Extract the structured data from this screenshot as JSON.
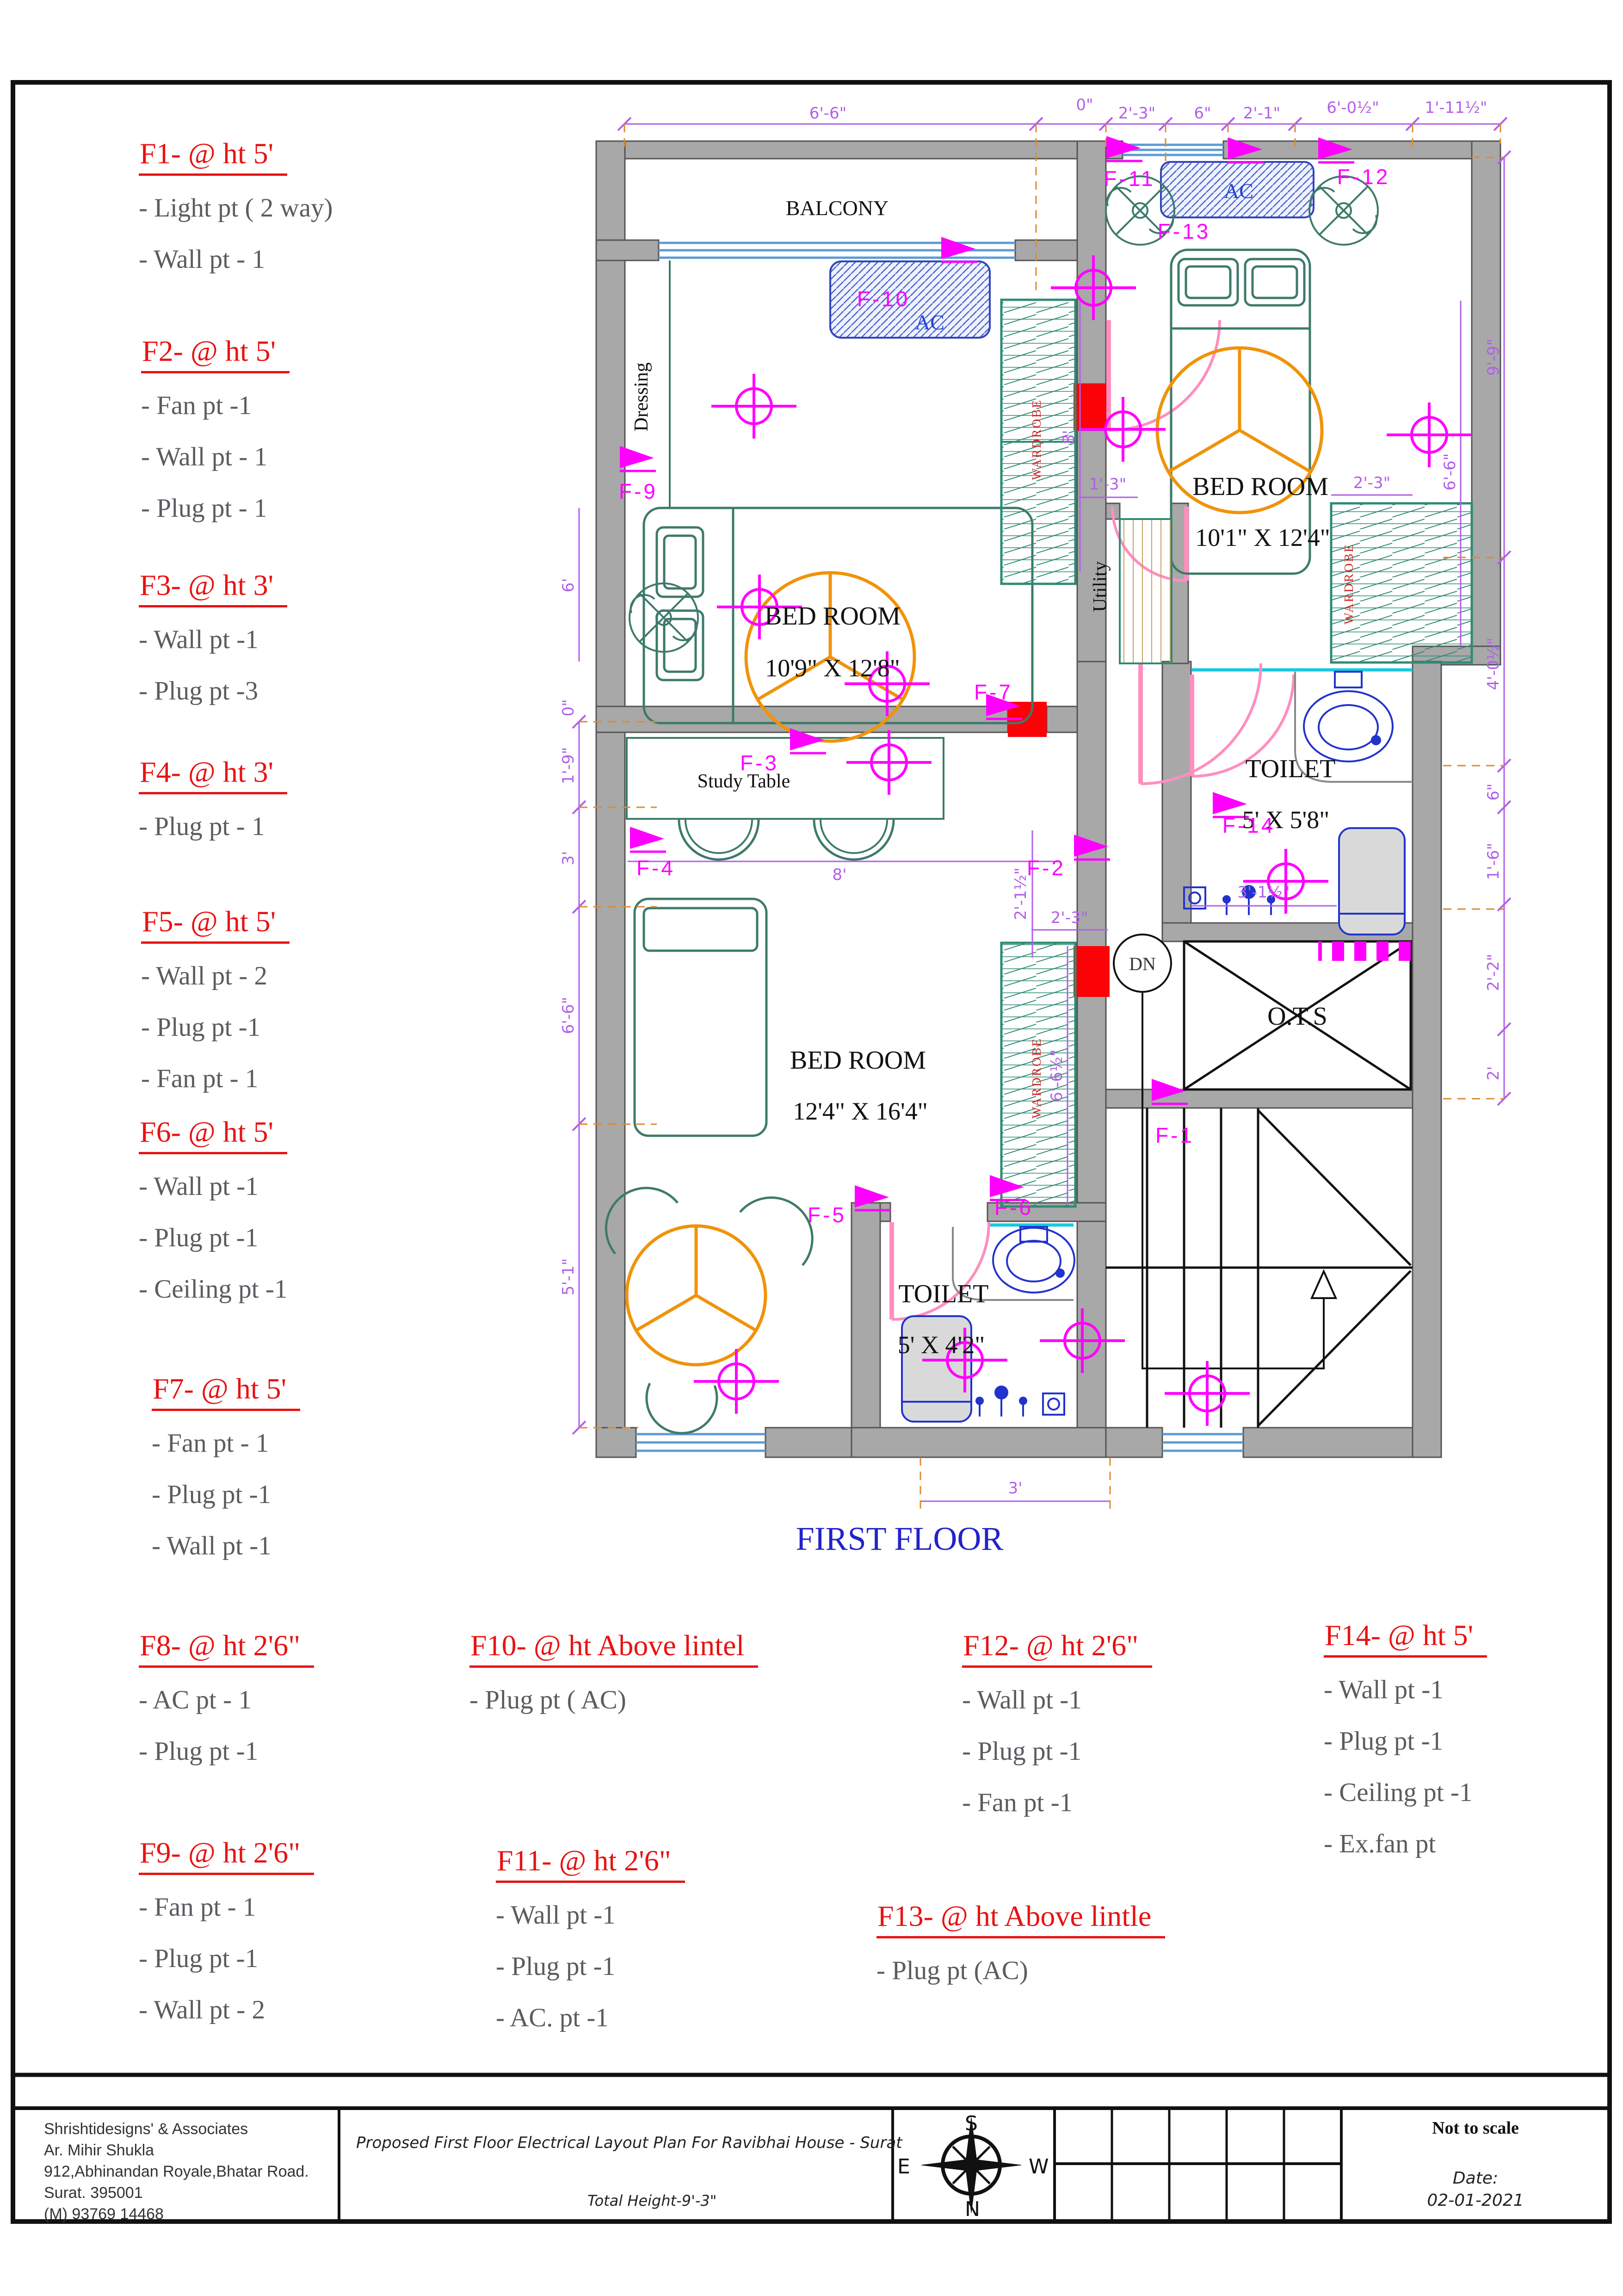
{
  "legend": [
    {
      "id": "F1",
      "title": "F1- @ ht 5'",
      "items": [
        "-  Light pt ( 2 way)",
        "-  Wall pt - 1"
      ]
    },
    {
      "id": "F2",
      "title": "F2- @ ht 5'",
      "items": [
        "- Fan pt -1",
        "- Wall pt - 1",
        "- Plug pt - 1"
      ]
    },
    {
      "id": "F3",
      "title": "F3- @ ht 3'",
      "items": [
        "- Wall pt -1",
        "-  Plug pt -3"
      ]
    },
    {
      "id": "F4",
      "title": "F4- @ ht 3'",
      "items": [
        "- Plug pt - 1"
      ]
    },
    {
      "id": "F5",
      "title": "F5- @ ht 5'",
      "items": [
        "- Wall pt - 2",
        "-  Plug pt -1",
        "-  Fan pt - 1"
      ]
    },
    {
      "id": "F6",
      "title": "F6- @ ht 5'",
      "items": [
        "- Wall pt -1",
        "- Plug pt -1",
        "- Ceiling pt -1"
      ]
    },
    {
      "id": "F7",
      "title": "F7- @ ht 5'",
      "items": [
        "- Fan pt - 1",
        "- Plug pt -1",
        "- Wall pt -1"
      ]
    },
    {
      "id": "F8",
      "title": "F8- @ ht 2'6\"",
      "items": [
        "- AC pt - 1",
        "- Plug pt -1"
      ]
    },
    {
      "id": "F9",
      "title": "F9- @ ht 2'6\"",
      "items": [
        "- Fan pt - 1",
        "- Plug pt -1",
        "- Wall pt - 2"
      ]
    },
    {
      "id": "F10",
      "title": "F10- @ ht Above lintel",
      "items": [
        "- Plug pt ( AC)"
      ]
    },
    {
      "id": "F11",
      "title": "F11- @ ht 2'6\"",
      "items": [
        "- Wall pt -1",
        "-  Plug pt -1",
        "-  AC. pt  -1"
      ]
    },
    {
      "id": "F12",
      "title": "F12- @ ht 2'6\"",
      "items": [
        "- Wall pt -1",
        "- Plug  pt -1",
        "- Fan pt -1"
      ]
    },
    {
      "id": "F13",
      "title": "F13- @ ht Above lintle",
      "items": [
        "- Plug  pt (AC)"
      ]
    },
    {
      "id": "F14",
      "title": "F14- @ ht 5'",
      "items": [
        "- Wall pt -1",
        "- Plug pt -1",
        "- Ceiling pt -1",
        "- Ex.fan pt"
      ]
    }
  ],
  "plan": {
    "balcony": "BALCONY",
    "dressing": "Dressing",
    "utility": "Utility",
    "study_table": "Study Table",
    "ots": "O.T.S",
    "dn": "DN",
    "wardrobe": "WARDROBE",
    "ac": "AC",
    "first_floor": "FIRST FLOOR",
    "bed1": {
      "name": "BED ROOM",
      "size": "10'9\" X 12'8\""
    },
    "bed2": {
      "name": "BED ROOM",
      "size": "10'1\" X 12'4\""
    },
    "bed3": {
      "name": "BED ROOM",
      "size": "12'4\" X 16'4\""
    },
    "toilet1": {
      "name": "TOILET",
      "size": "5' X 5'8\""
    },
    "toilet2": {
      "name": "TOILET",
      "size": "5' X 4'2\""
    },
    "fixtures": {
      "f1": "F-1",
      "f2": "F-2",
      "f3": "F-3",
      "f4": "F-4",
      "f5": "F-5",
      "f6": "F-6",
      "f7": "F-7",
      "f9": "F-9",
      "f10": "F-10",
      "f11": "F-11",
      "f12": "F-12",
      "f13": "F-13",
      "f14": "F-14"
    },
    "dims": {
      "top": [
        "6'-6\"",
        "0\"",
        "2'-3\"",
        "6\"",
        "2'-1\"",
        "6'-0½\"",
        "1'-11½\""
      ],
      "right": [
        "9'-9\"",
        "4'-0½\"",
        "6\"",
        "1'-6\"",
        "2'-2\"",
        "2'"
      ],
      "left": [
        "6'",
        "0\"",
        "1'-9\"",
        "3'",
        "6'-6\"",
        "5'-1\""
      ],
      "inner": {
        "study_w": "8'",
        "bed1_h": "8'",
        "lobby": "2'-1½\"",
        "ward3": "2'-3\"",
        "ward2": "2'-3\"",
        "utility": "1'-3\"",
        "bed3_h": "6'-6½\"",
        "shower": "3'-1½\"",
        "toilet2_w": "3'",
        "bed2_h": "6'-6\""
      }
    }
  },
  "titleblock": {
    "company": [
      "Shrishtidesigns' & Associates",
      "Ar. Mihir Shukla",
      "912,Abhinandan Royale,Bhatar Road.",
      "Surat. 395001",
      "(M) 93769 14468"
    ],
    "project": "Proposed First Floor Electrical Layout Plan For Ravibhai House - Surat",
    "total_height": "Total Height-9'-3\"",
    "compass": {
      "n": "N",
      "s": "S",
      "e": "E",
      "w": "W"
    },
    "scale_note": "Not  to scale",
    "date_label": "Date:",
    "date": "02-01-2021"
  }
}
